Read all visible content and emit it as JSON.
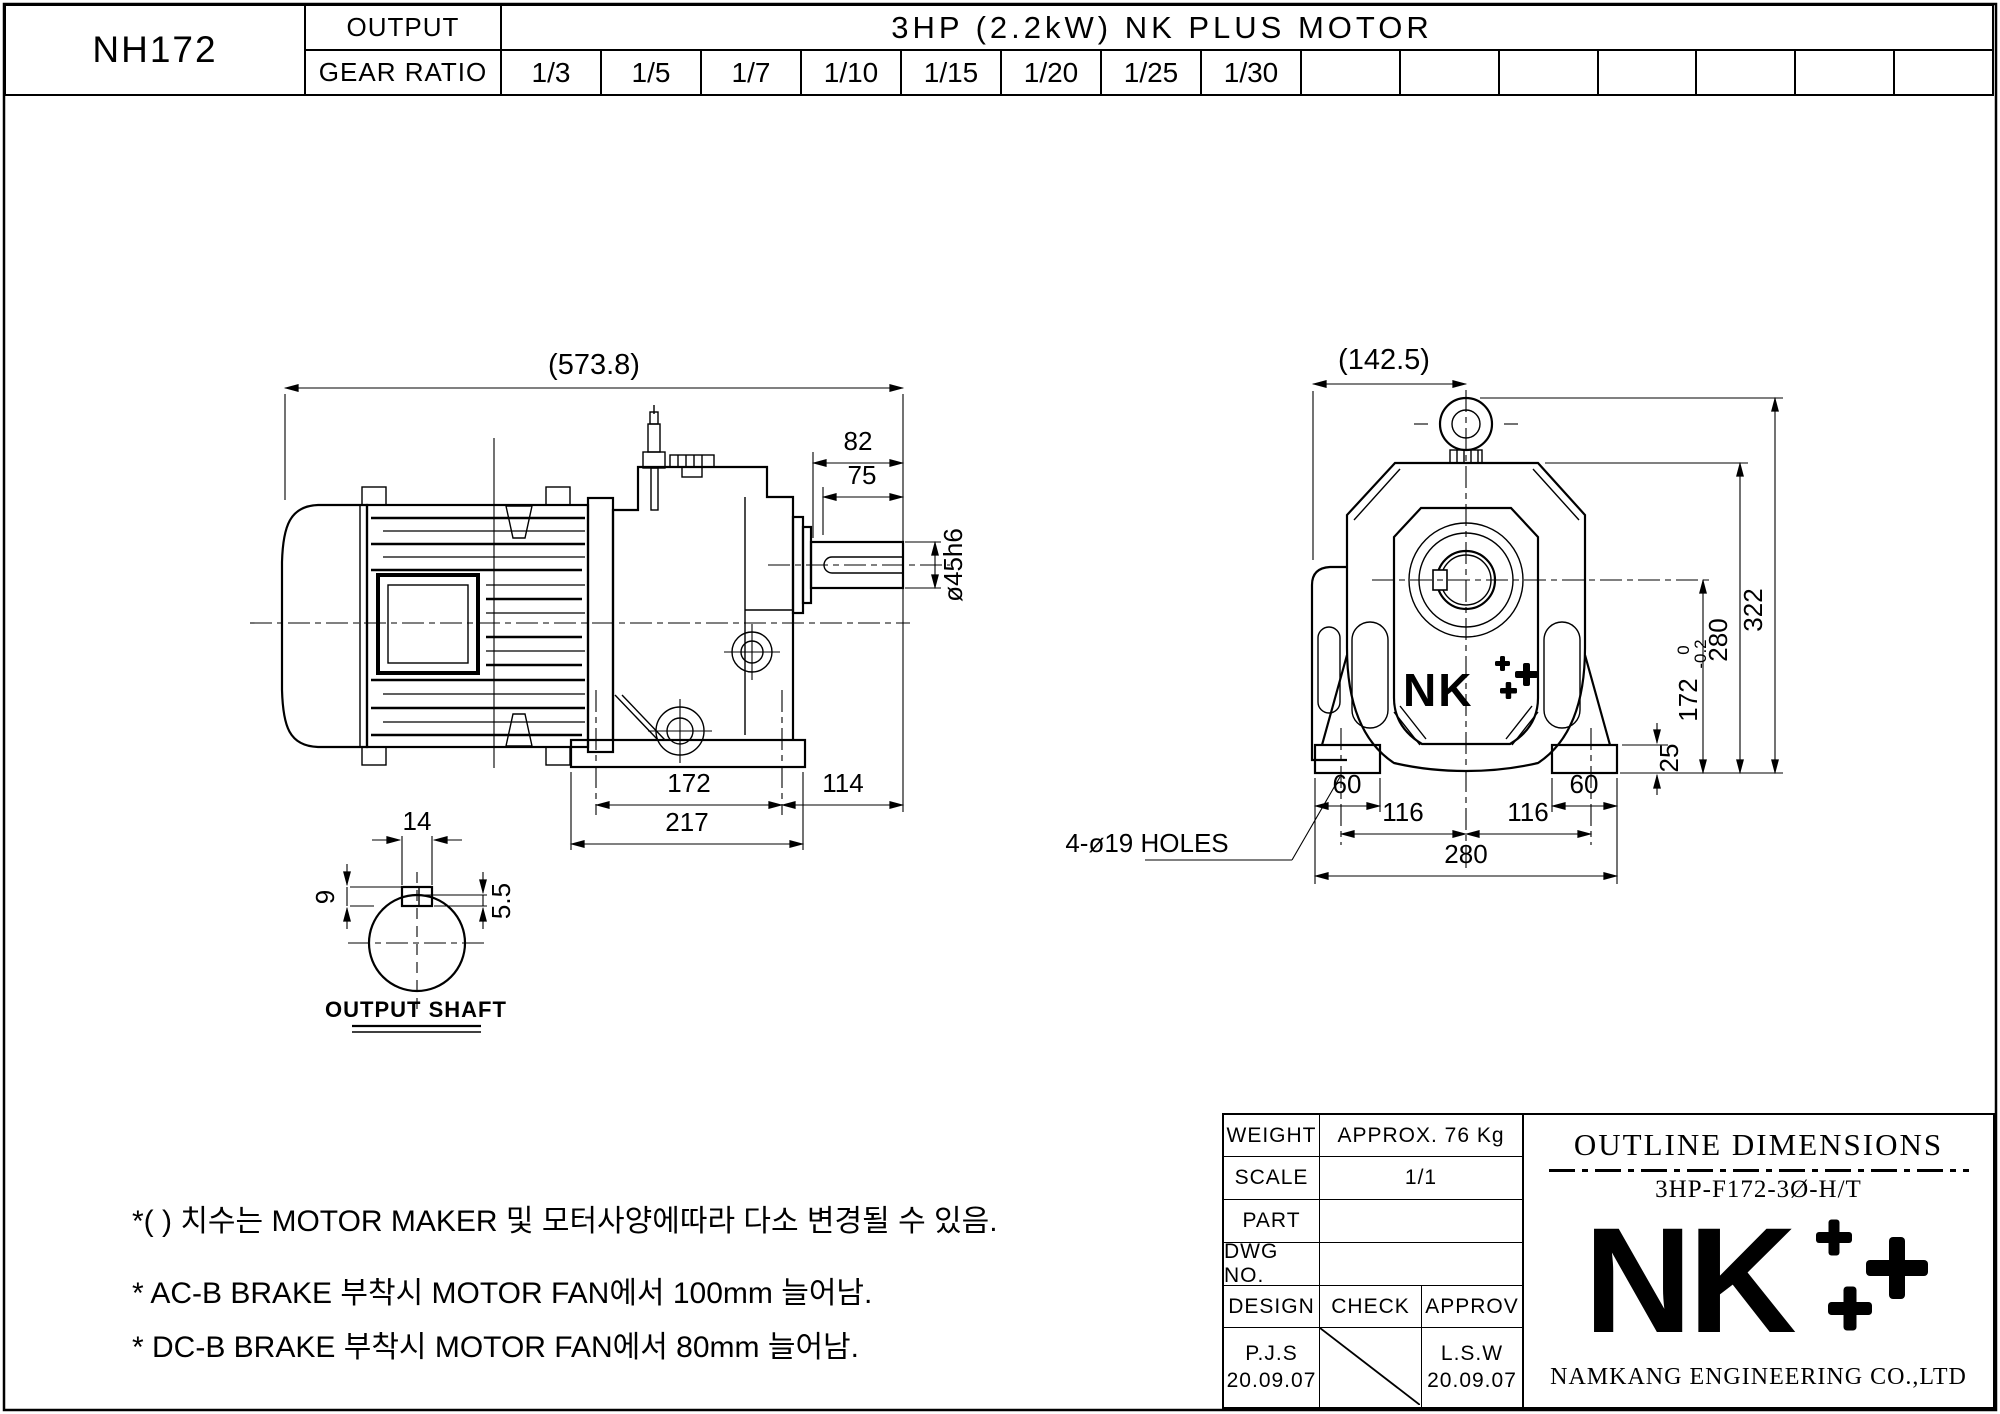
{
  "page": {
    "background": "#ffffff",
    "line_color": "#000000"
  },
  "header": {
    "model": "NH172",
    "output_label": "OUTPUT",
    "gear_ratio_label": "GEAR RATIO",
    "motor_title": "3HP (2.2kW) NK PLUS MOTOR",
    "gear_ratios": [
      "1/3",
      "1/5",
      "1/7",
      "1/10",
      "1/15",
      "1/20",
      "1/25",
      "1/30"
    ]
  },
  "side_view": {
    "dims": {
      "overall_length": "(573.8)",
      "shaft_ext": "82",
      "shaft_len": "75",
      "shaft_dia": "ø45h6",
      "hole_pitch": "172",
      "overhang": "114",
      "base_length": "217"
    }
  },
  "shaft_detail": {
    "label": "OUTPUT SHAFT",
    "dims": {
      "key_width": "14",
      "keyway_height": "9",
      "key_protrusion": "5.5"
    }
  },
  "front_view": {
    "logo": "NK",
    "holes_note": "4-ø19 HOLES",
    "dims": {
      "center_offset": "(142.5)",
      "overall_height": "322",
      "housing_height": "280",
      "shaft_center_height": "172",
      "tol_upper": "0",
      "tol_lower": "-0.2",
      "foot_height": "25",
      "foot_width_left": "60",
      "foot_width_right": "60",
      "hole_pitch_left": "116",
      "hole_pitch_right": "116",
      "base_width": "280"
    }
  },
  "notes": [
    "*( ) 치수는 MOTOR MAKER 및 모터사양에따라 다소 변경될 수 있음.",
    "* AC-B BRAKE 부착시 MOTOR FAN에서 100mm 늘어남.",
    "* DC-B BRAKE 부착시 MOTOR FAN에서 80mm 늘어남."
  ],
  "title_block": {
    "weight_label": "WEIGHT",
    "weight_value": "APPROX. 76 Kg",
    "scale_label": "SCALE",
    "scale_value": "1/1",
    "part_label": "PART",
    "part_value": "",
    "dwg_label": "DWG NO.",
    "dwg_value": "",
    "design_label": "DESIGN",
    "check_label": "CHECK",
    "approv_label": "APPROV",
    "design_sign": "P.J.S",
    "design_date": "20.09.07",
    "check_sign": "",
    "approv_sign": "L.S.W",
    "approv_date": "20.09.07",
    "doc_title": "OUTLINE DIMENSIONS",
    "doc_code": "3HP-F172-3Ø-H/T",
    "logo_text": "NK",
    "company": "NAMKANG ENGINEERING CO.,LTD"
  }
}
